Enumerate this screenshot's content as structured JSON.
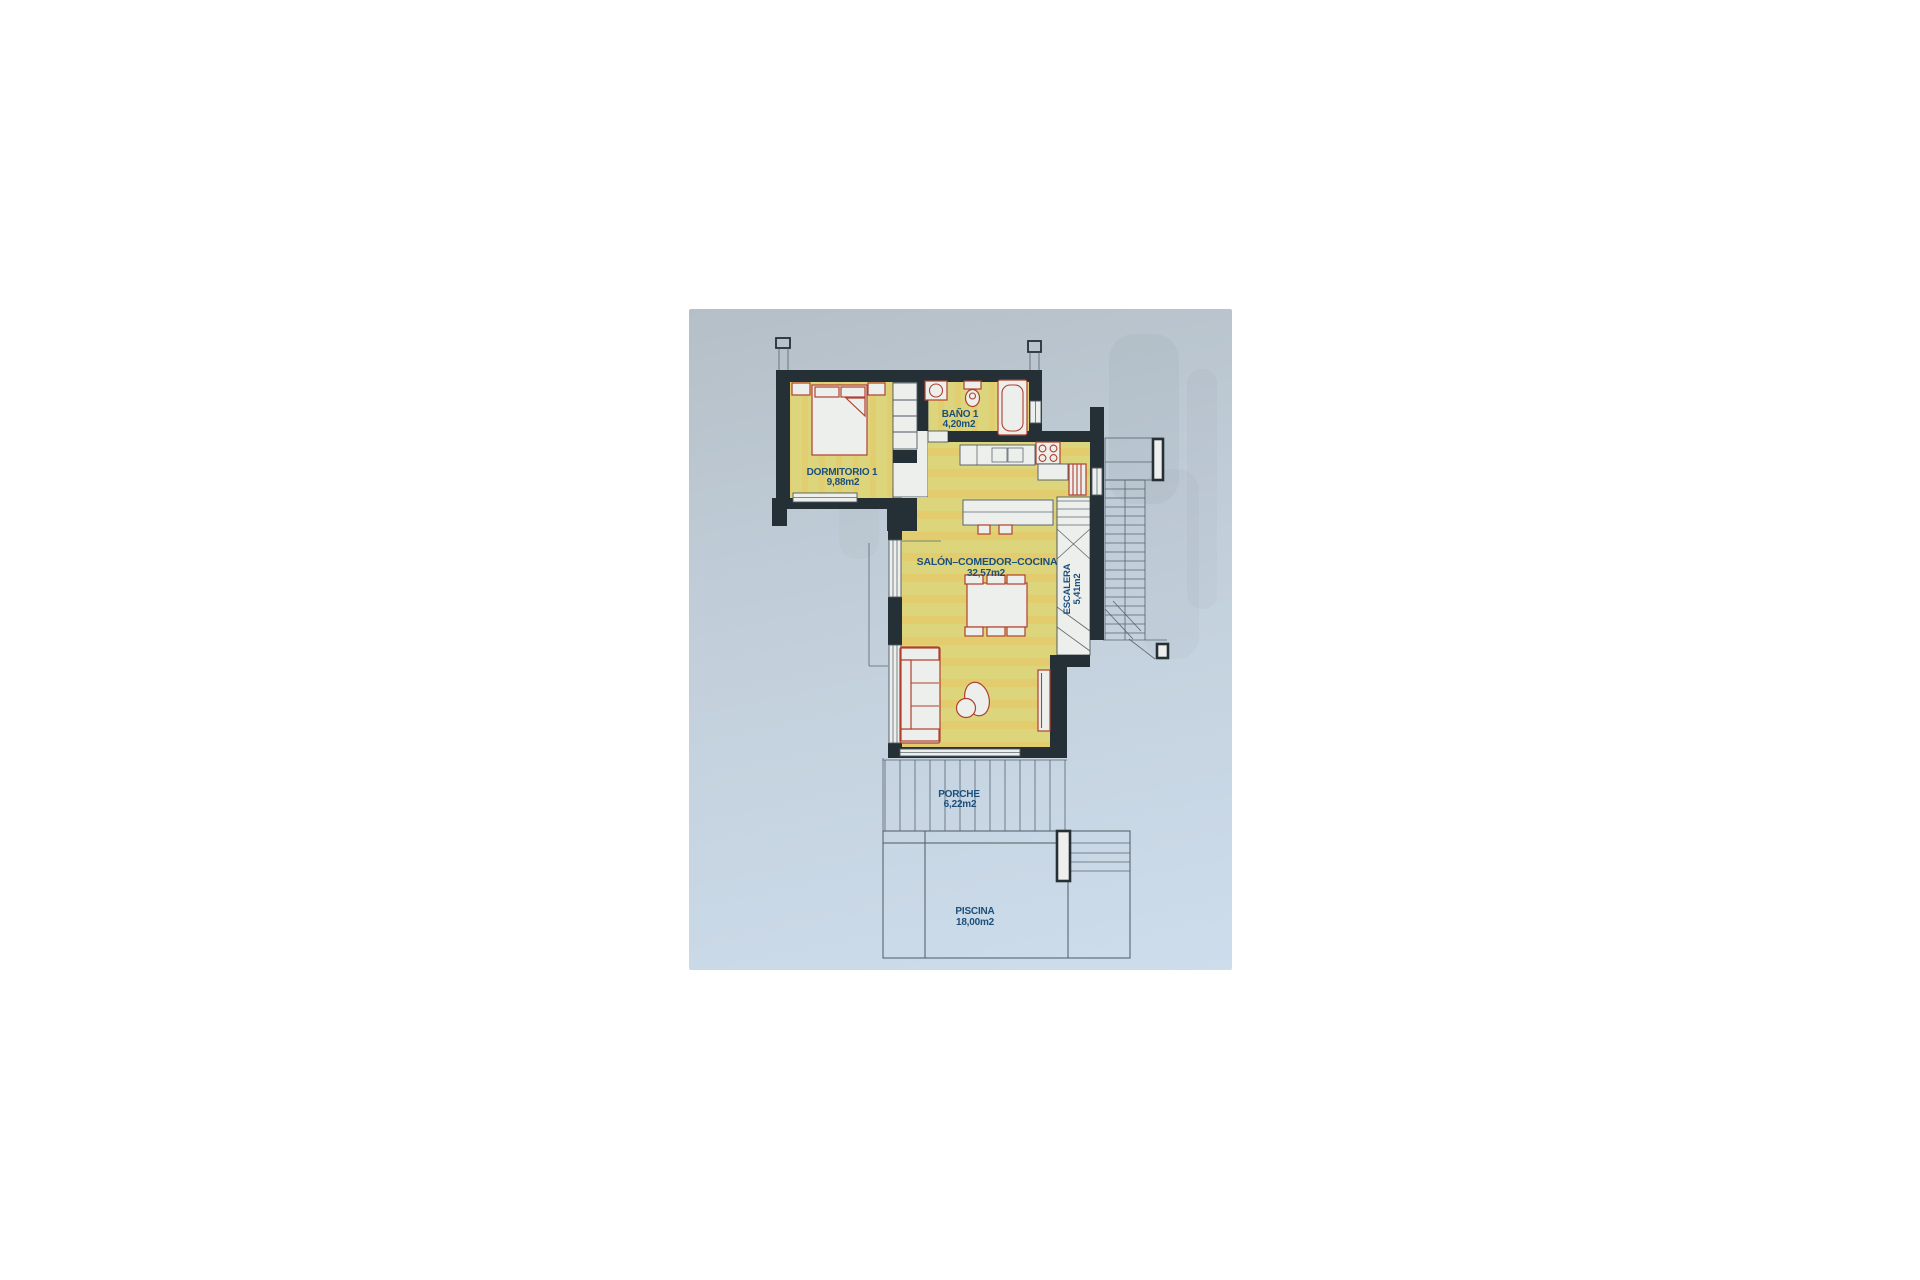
{
  "photo": {
    "description": "scanned-floor-plan-photo",
    "rooms": {
      "dormitorio": {
        "name": "DORMITORIO 1",
        "area": "9,88m2"
      },
      "bano": {
        "name": "BAÑO 1",
        "area": "4,20m2"
      },
      "salon": {
        "name": "SALÓN–COMEDOR–COCINA",
        "area": "32,57m2"
      },
      "escalera": {
        "name": "ESCALERA",
        "area": "5,41m2"
      },
      "porche": {
        "name": "PORCHE",
        "area": "6,22m2"
      },
      "piscina": {
        "name": "PISCINA",
        "area": "18,00m2"
      }
    }
  },
  "colors": {
    "page_bg": "#ffffff",
    "paper_top": "#b5bfc7",
    "paper_mid": "#c3d0dc",
    "paper_bottom": "#cdddec",
    "wall": "#252f36",
    "line": "#4e5a62",
    "red": "#b0402e",
    "blue": "#1b4f7c",
    "floor": "#ddd57c",
    "floor_band": "#e6c763",
    "white_fill": "#edefec"
  }
}
